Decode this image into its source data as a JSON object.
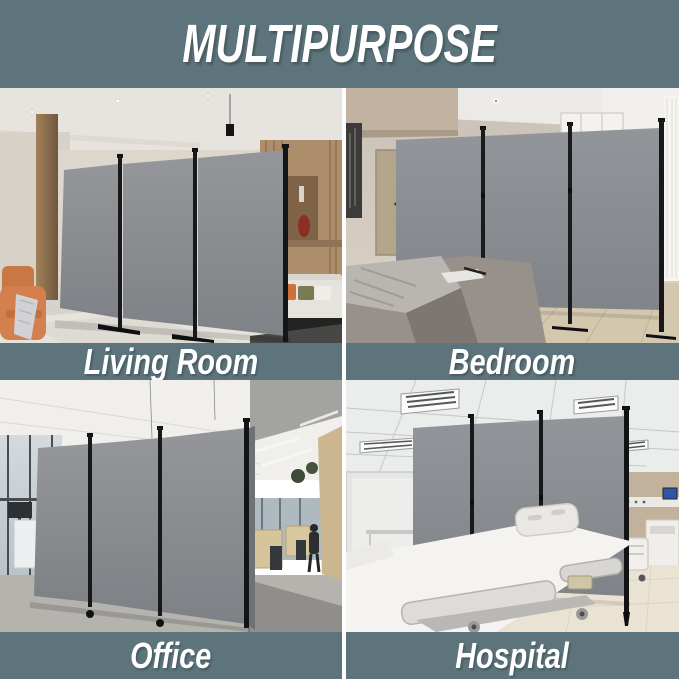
{
  "header": {
    "title": "MULTIPURPOSE"
  },
  "scenes": [
    {
      "id": "living-room",
      "label": "Living Room",
      "alt": "Grey 3-panel folding room divider standing in a modern living room with orange armchair, wood column and sofa"
    },
    {
      "id": "bedroom",
      "label": "Bedroom",
      "alt": "Grey 3-panel folding room divider standing behind a bed with grey blanket in a beige bedroom"
    },
    {
      "id": "office",
      "label": "Office",
      "alt": "Grey 3-panel folding room divider on wheels separating desks in an open-plan office"
    },
    {
      "id": "hospital",
      "label": "Hospital",
      "alt": "Grey 3-panel folding room divider between white hospital beds under a grid ceiling with fluorescent lights"
    }
  ],
  "colors": {
    "accent_teal": "#5d747c",
    "label_text": "#ffffff",
    "separator_white": "#ffffff",
    "divider_panel_grey": "#8a8d91",
    "divider_frame_black": "#17181a"
  }
}
